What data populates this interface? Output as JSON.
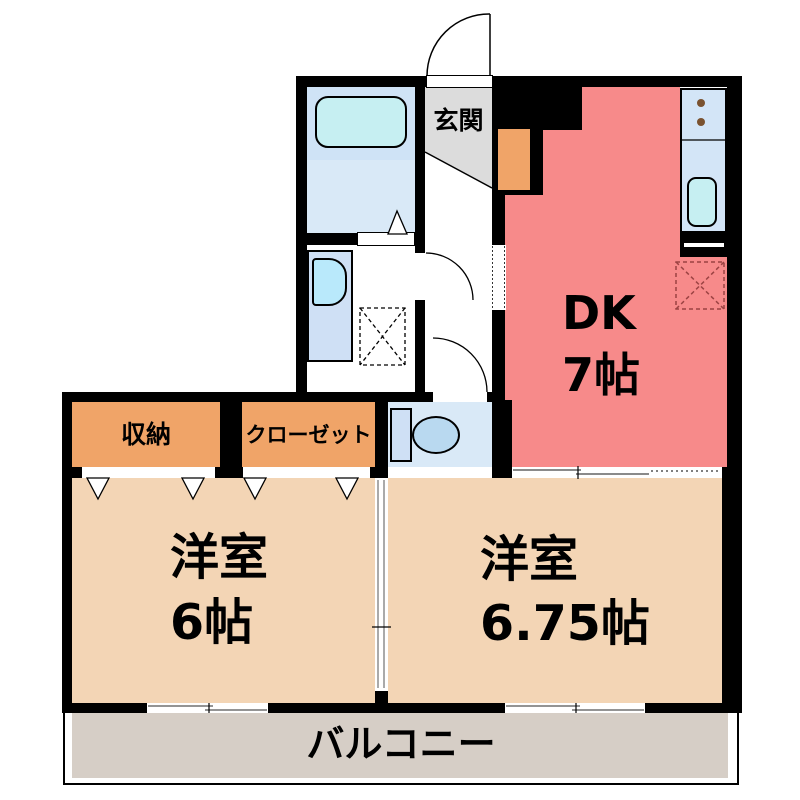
{
  "plan_title": "apartment-floor-plan",
  "rooms": {
    "genkan": {
      "label": "玄関"
    },
    "dk": {
      "line1": "DK",
      "line2": "7帖"
    },
    "shuno": {
      "label": "収納"
    },
    "closet": {
      "label": "クローゼット"
    },
    "west1": {
      "line1": "洋室",
      "line2": "6帖"
    },
    "west2": {
      "line1": "洋室",
      "line2": "6.75帖"
    },
    "balcony": {
      "label": "バルコニー"
    }
  },
  "colors": {
    "wall": "#000000",
    "dk_room": "#f78a8a",
    "western_room": "#f3d5b5",
    "storage_orange": "#f0a468",
    "balcony_gray": "#d6cec6",
    "genkan_floor": "#dcdcdc",
    "water_area_blue": "#d9e9f7",
    "fixture_cyan": "#c6eff2",
    "refrigerator_dash": "#9c4343"
  },
  "fixtures": [
    "bathtub",
    "washbasin",
    "washing-machine-space",
    "toilet",
    "kitchen-counter",
    "stove",
    "sink",
    "refrigerator-space",
    "shoe-cabinet",
    "entrance-door",
    "interior-doors",
    "sliding-doors",
    "windows",
    "folding-doors"
  ]
}
